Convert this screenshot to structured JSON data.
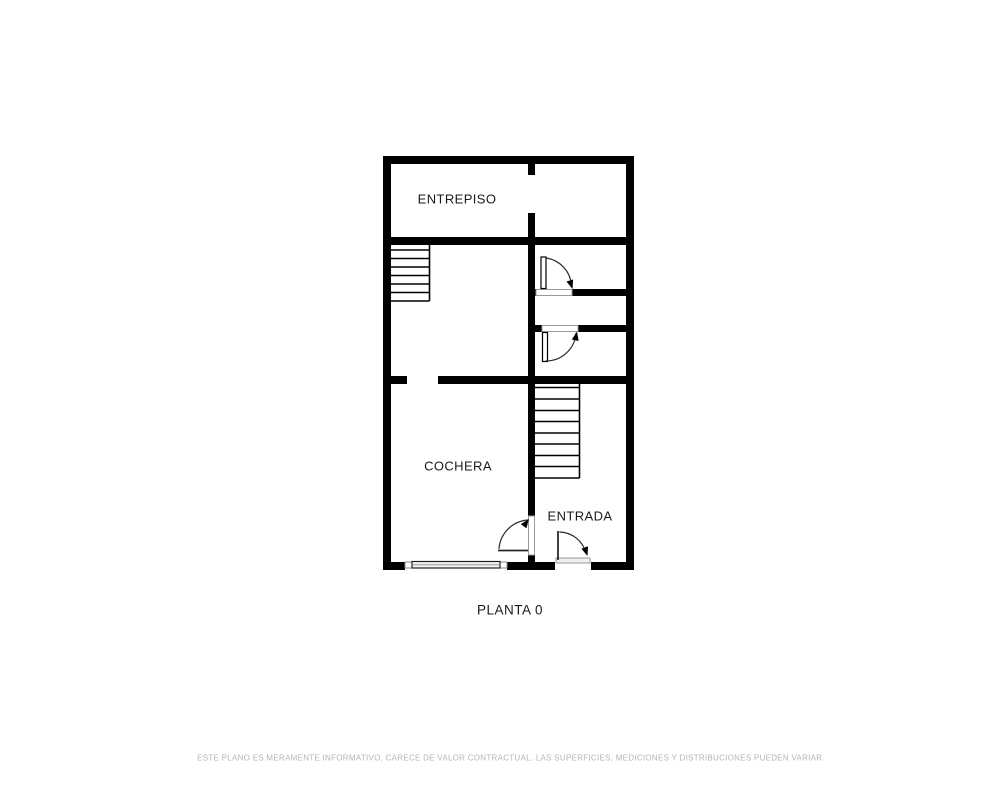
{
  "plan": {
    "rooms": [
      {
        "name": "ENTREPISO"
      },
      {
        "name": "COCHERA"
      },
      {
        "name": "ENTRADA"
      }
    ],
    "floor_label": "PLANTA 0",
    "stairs": {
      "upper_treads": 7,
      "lower_treads": 9
    },
    "doors": 4,
    "garage_doors": 1,
    "colors": {
      "wall": "#000000",
      "label_text": "#1a1a1a",
      "door_line": "#2a2a2a",
      "threshold_outline": "#999999"
    }
  },
  "footer": {
    "disclaimer": "ESTE PLANO ES MERAMENTE INFORMATIVO, CARECE DE VALOR CONTRACTUAL. LAS SUPERFICIES, MEDICIONES Y DISTRIBUCIONES PUEDEN VARIAR.",
    "text_color": "#b5b5b5"
  }
}
